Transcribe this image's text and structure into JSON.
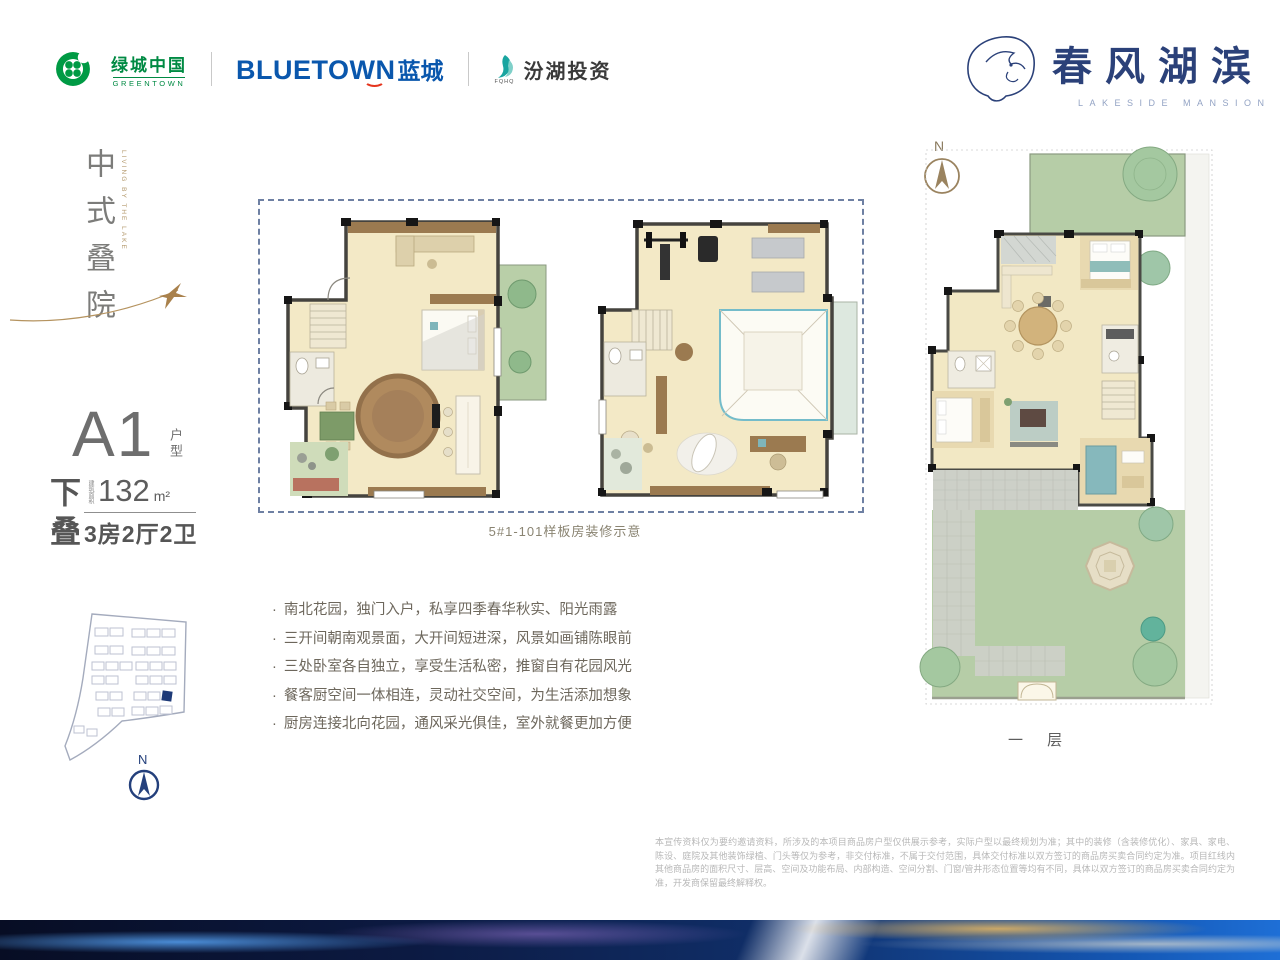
{
  "header": {
    "logos": {
      "greentown": {
        "name_cn": "绿城中国",
        "name_en": "GREENTOWN"
      },
      "bluetown": {
        "name_en": "BLUETOWN",
        "name_cn": "蓝城"
      },
      "fenhu": {
        "abbr": "FQHQ",
        "name_cn": "汾湖投资"
      }
    },
    "brand": {
      "name_cn": "春风湖滨",
      "name_en": "LAKESIDE MANSION"
    }
  },
  "left_panel": {
    "slogan": "中式叠院",
    "slogan_en": "LIVING BY THE LAKE",
    "unit": {
      "code": "A1",
      "code_suffix": "户型",
      "stack": "下叠",
      "area_label": "建筑面积",
      "area_value": "132",
      "area_unit": "m²",
      "rooms": "3房2厅2卫"
    },
    "site_compass": "N"
  },
  "middle": {
    "caption": "5#1-101样板房装修示意",
    "features": [
      "南北花园，独门入户，私享四季春华秋实、阳光雨露",
      "三开间朝南观景面，大开间短进深，风景如画铺陈眼前",
      "三处卧室各自独立，享受生活私密，推窗自有花园风光",
      "餐客厨空间一体相连，灵动社交空间，为生活添加想象",
      "厨房连接北向花园，通风采光俱佳，室外就餐更加方便"
    ]
  },
  "right_plan": {
    "compass": "N",
    "floor_label": "一 层"
  },
  "footer": {
    "disclaimer": "本宣传资料仅为要约邀请资料，所涉及的本项目商品房户型仅供展示参考，实际户型以最终规划为准；其中的装修（含装修优化）、家具、家电、陈设、庭院及其他装饰绿植、门头等仅为参考，非交付标准，不属于交付范围，具体交付标准以双方签订的商品房买卖合同约定为准。项目红线内其他商品房的面积尺寸、层高、空间及功能布局、内部构造、空间分割、门窗/管井形态位置等均有不同，具体以双方签订的商品房买卖合同约定为准，开发商保留最终解释权。"
  },
  "colors": {
    "greentown_green": "#008a43",
    "bluetown_blue": "#0a57ad",
    "accent_red": "#e5351e",
    "fenhu_teal": "#19a5a0",
    "brand_navy": "#2b4179",
    "gold": "#b5935f",
    "floor_cream": "#f2e8c4",
    "lawn_green": "#b6cda7",
    "wall_gray": "#4a4a45"
  }
}
